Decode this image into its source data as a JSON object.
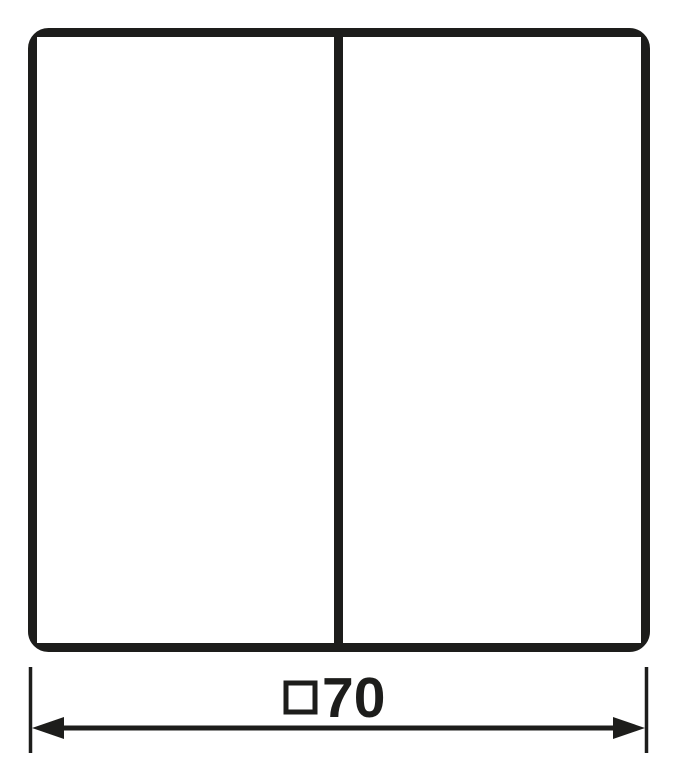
{
  "drawing": {
    "dimension": {
      "symbol": "□",
      "value": "70",
      "label": "□70"
    },
    "colors": {
      "line": "#1d1d1b",
      "background": "#ffffff"
    }
  }
}
